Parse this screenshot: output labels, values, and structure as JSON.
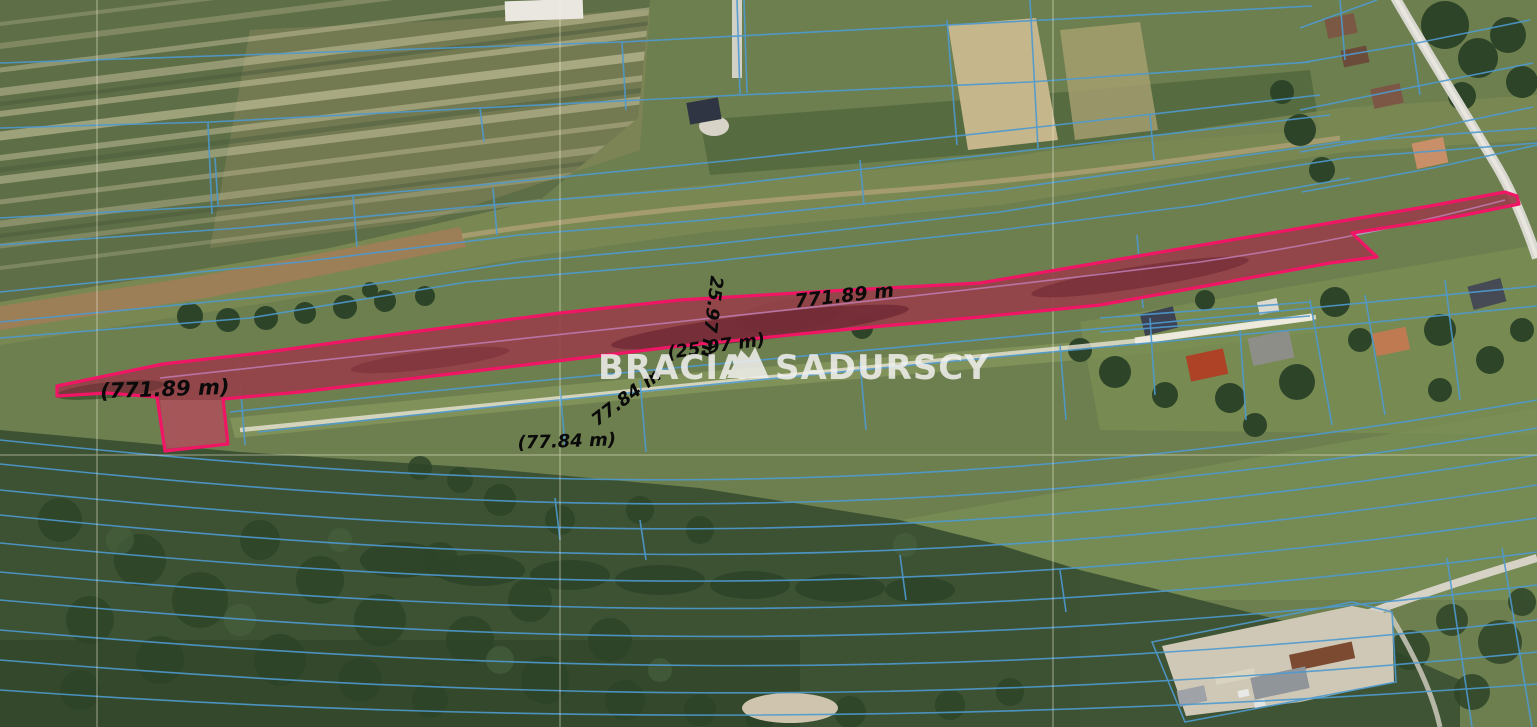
{
  "watermark": {
    "word1": "BRACIA",
    "word2": "SADURSCY",
    "color": "#f2f2f0",
    "logo_icon": "mountains-logo"
  },
  "measurements": {
    "top_length": "771.89 m",
    "left_length_paren": "(771.89 m)",
    "width_vertical": "25.97 m",
    "width_paren": "(25.97 m)",
    "cross_length": "77.84 m",
    "cross_length_paren": "(77.84 m)"
  },
  "colors": {
    "parcel_outline": "#f01565",
    "parcel_fill": "rgba(208,24,80,0.30)",
    "cadastral_line": "#4e9ad0",
    "survey_grid_line": "#f4efda",
    "label_color": "#0a0a0a"
  }
}
